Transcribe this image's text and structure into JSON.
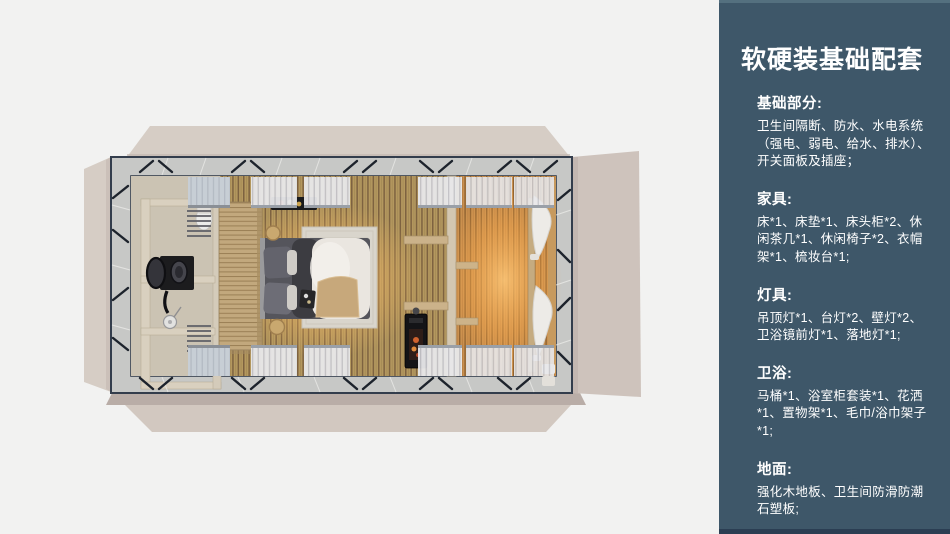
{
  "sidebar": {
    "title": "软硬装基础配套",
    "bg": "#3e5769",
    "sections": [
      {
        "heading": "基础部分:",
        "body": "卫生间隔断、防水、水电系统（强电、弱电、给水、排水）、开关面板及插座；"
      },
      {
        "heading": "家具:",
        "body": "床*1、床垫*1、床头柜*2、休闲茶几*1、休闲椅子*2、衣帽架*1、梳妆台*1;"
      },
      {
        "heading": "灯具:",
        "body": "吊顶灯*1、台灯*2、壁灯*2、卫浴镜前灯*1、落地灯*1;"
      },
      {
        "heading": "卫浴:",
        "body": "马桶*1、浴室柜套装*1、花洒*1、置物架*1、毛巾/浴巾架子*1;"
      },
      {
        "heading": "地面:",
        "body": "强化木地板、卫生间防滑防潮石塑板;"
      }
    ]
  },
  "floorplan": {
    "palette": {
      "slide_bg": "#f2f2f1",
      "flap_beige": "#d6cdc5",
      "flap_shadow": "#b9ada7",
      "frame_band": "#c7c8c6",
      "frame_line": "#333d4c",
      "wood_floor": "#b4985f",
      "wood_warm": "#c9904f",
      "bathroom_floor": "#cbc3b3",
      "cabinet_beige": "#d9d0bf",
      "bed_white": "#eae6e0",
      "glow": "#ffb95f"
    }
  }
}
